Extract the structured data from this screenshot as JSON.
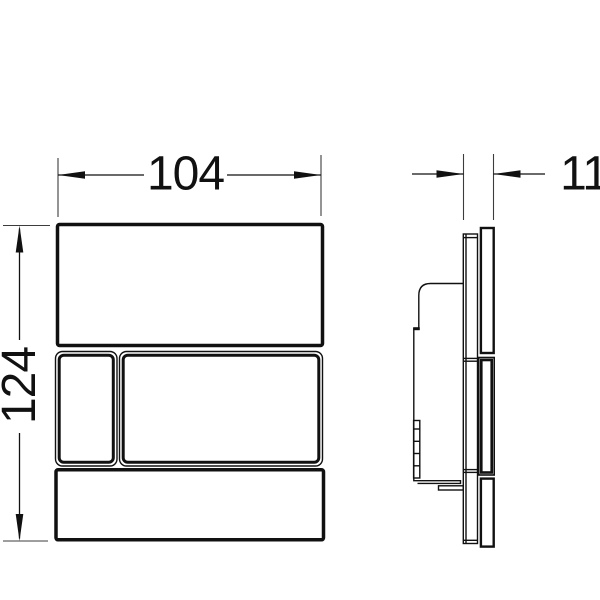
{
  "drawing": {
    "ink_color": "#111111",
    "paper_color": "#ffffff",
    "dimension_labels": {
      "width": "104",
      "height": "124",
      "depth": "11"
    }
  }
}
